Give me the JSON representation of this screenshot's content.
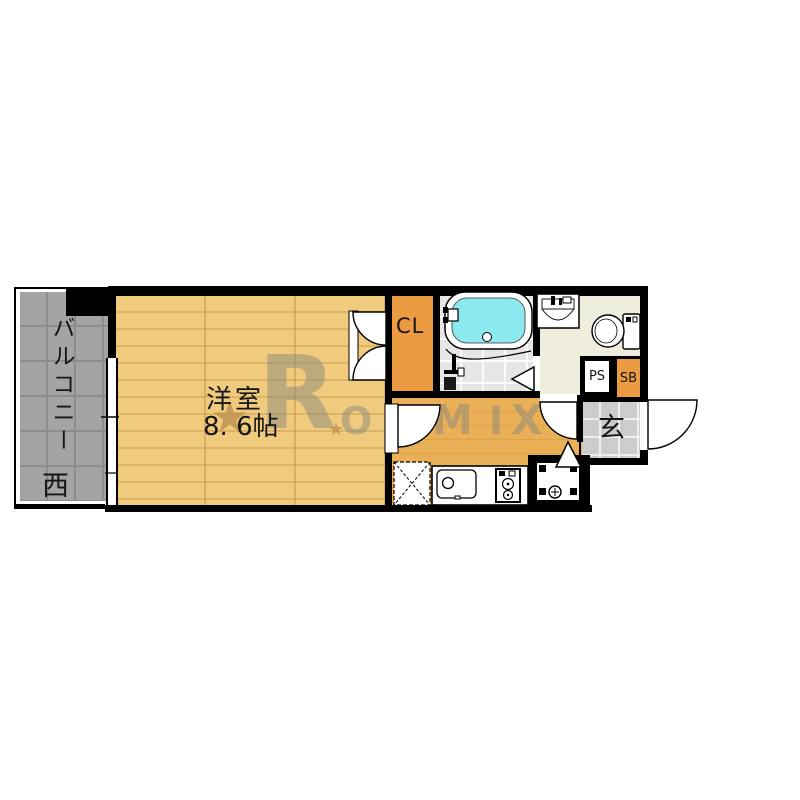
{
  "image_type": "apartment floor plan",
  "rooms": {
    "balcony": {
      "label": "バルコニー",
      "direction": "西"
    },
    "western_room": {
      "label": "洋室",
      "size": "8. 6帖"
    },
    "closet": {
      "label": "CL"
    },
    "entrance": {
      "label": "玄"
    },
    "pipe_space": {
      "label": "PS"
    },
    "shoe_box": {
      "label": "SB"
    }
  },
  "watermark": {
    "letter_r": "R",
    "letter_o1": "O",
    "letter_o2": "O",
    "letter_m": "M",
    "letter_i": "I",
    "letter_x": "X",
    "star": "★",
    "star_small": "★"
  },
  "colors": {
    "wall": "#000000",
    "room_floor": "#f0cb7d",
    "room_plank_line": "#ddb368",
    "hallway_floor": "#e9b057",
    "hallway_line": "#dfa14b",
    "balcony_tile": "#a4a4a4",
    "balcony_line": "#8d8d8d",
    "genkan_tile": "#cccccc",
    "closet": "#ec9b42",
    "washroom": "#efeddc",
    "bathroom_tile": "#e6e6e6",
    "bathtub_water": "#8ce9ef",
    "watermark_gray": "#8a8a7e",
    "watermark_star": "#bd9150"
  }
}
